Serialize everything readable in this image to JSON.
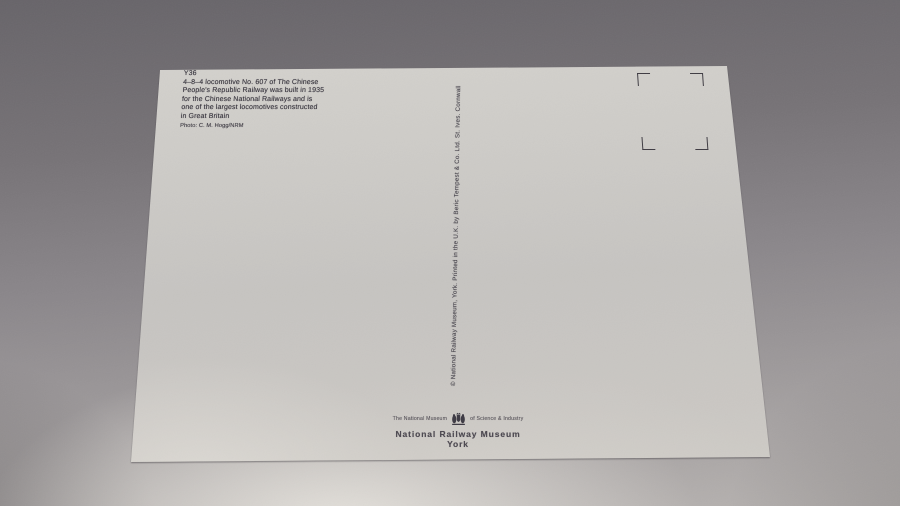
{
  "scene": {
    "description": "photograph of the reverse (address) side of a blank postcard lying on a grey surface",
    "background_top_color": "#676469",
    "background_bottom_color": "#b6b2b0",
    "card_color": "#cccac6",
    "ink_color": "#3a3740"
  },
  "card": {
    "code": "Y36",
    "caption_lines": [
      "4–8–4 locomotive No. 607 of The Chinese",
      "People's Republic Railway was built in 1935",
      "for the Chinese National Railways and is",
      "one of the largest locomotives constructed",
      "in Great Britain"
    ],
    "photo_credit": "Photo: C. M. Hogg/NRM",
    "printer_credit": "© National Railway Museum, York. Printed in the U.K. by Beric Tempest & Co. Ltd. St. Ives. Cornwall",
    "stamp_box": {
      "corner_marks": 4
    },
    "publisher": {
      "prefix": "The National Museum",
      "suffix": "of Science & Industry",
      "crest_icon": "coat-of-arms",
      "name": "National Railway Museum",
      "place": "York"
    }
  }
}
